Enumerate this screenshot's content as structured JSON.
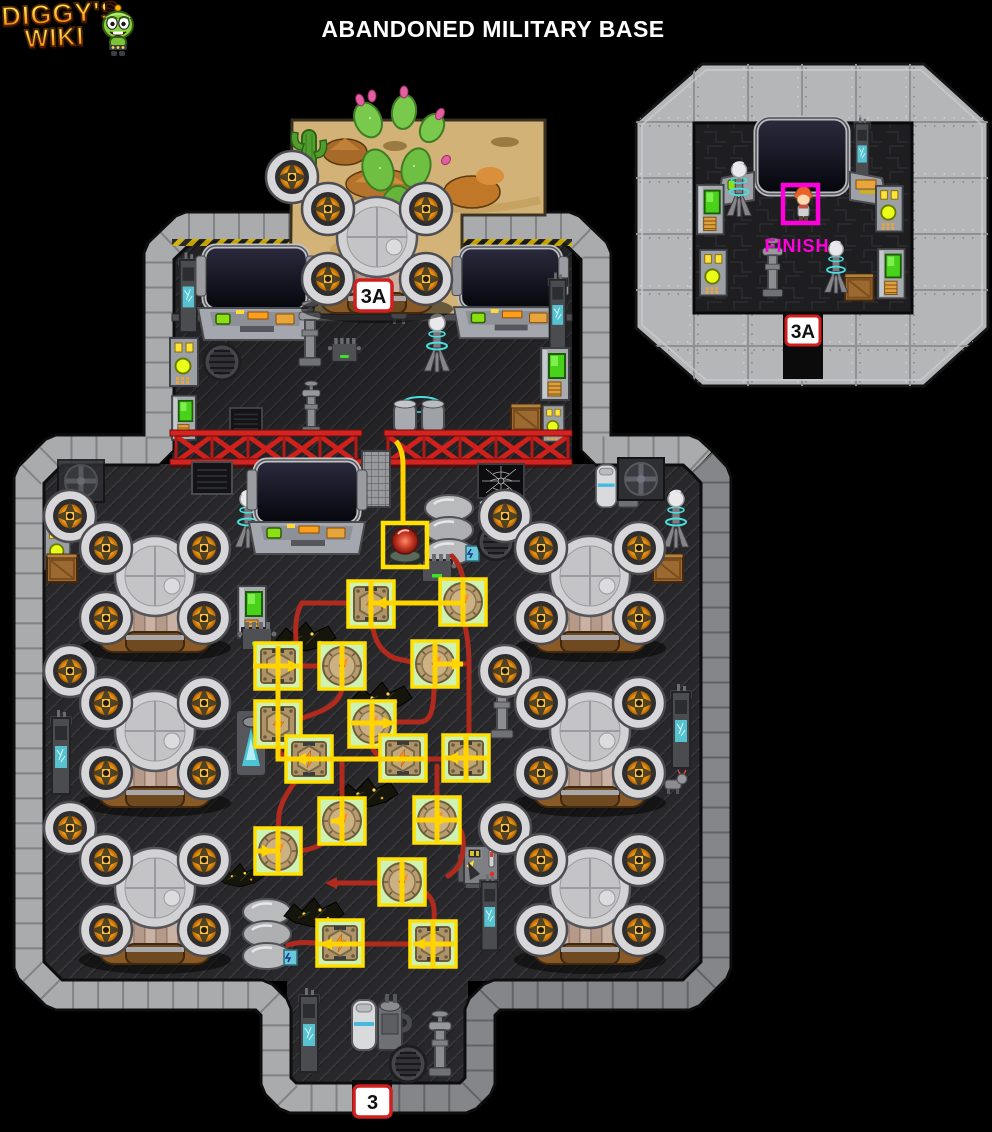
{
  "header": {
    "logo": {
      "line1": "DIGGY'S",
      "line2": "WIKI"
    },
    "title": "ABANDONED MILITARY BASE"
  },
  "main_map": {
    "exit_top": {
      "label": "3A"
    },
    "exit_bottom": {
      "label": "3"
    }
  },
  "inset_map": {
    "selection": {
      "label": "FINISH"
    },
    "exit": {
      "label": "3A"
    }
  },
  "colors": {
    "background": "#000000",
    "title_text": "#ffffff",
    "logo_gradient_top": "#ffe14a",
    "logo_gradient_bottom": "#ff8a00",
    "logo_outline": "#4a1a05",
    "wall_light": "#a9abad",
    "wall_dark": "#85868a",
    "floor": "#28282b",
    "sand": "#d7b679",
    "cactus_green": "#5aa832",
    "cactus_flower_pink": "#e060a0",
    "fence_red": "#cf201c",
    "wire_red": "#b02a1e",
    "route_yellow": "#ffd400",
    "node_highlight_border": "#ffe000",
    "node_highlight_fill": "#cdf2b2",
    "valve_tan": "#b89c6e",
    "button_red": "#c13422",
    "fan_glow": "#ffb020",
    "hologram_teal": "#49e0e0",
    "exit_label_bg": "#ffffff",
    "exit_label_border": "#cf1f1f",
    "exit_label_text": "#111111",
    "finish_magenta": "#ff00dd",
    "selection_magenta": "#ff00dd"
  }
}
